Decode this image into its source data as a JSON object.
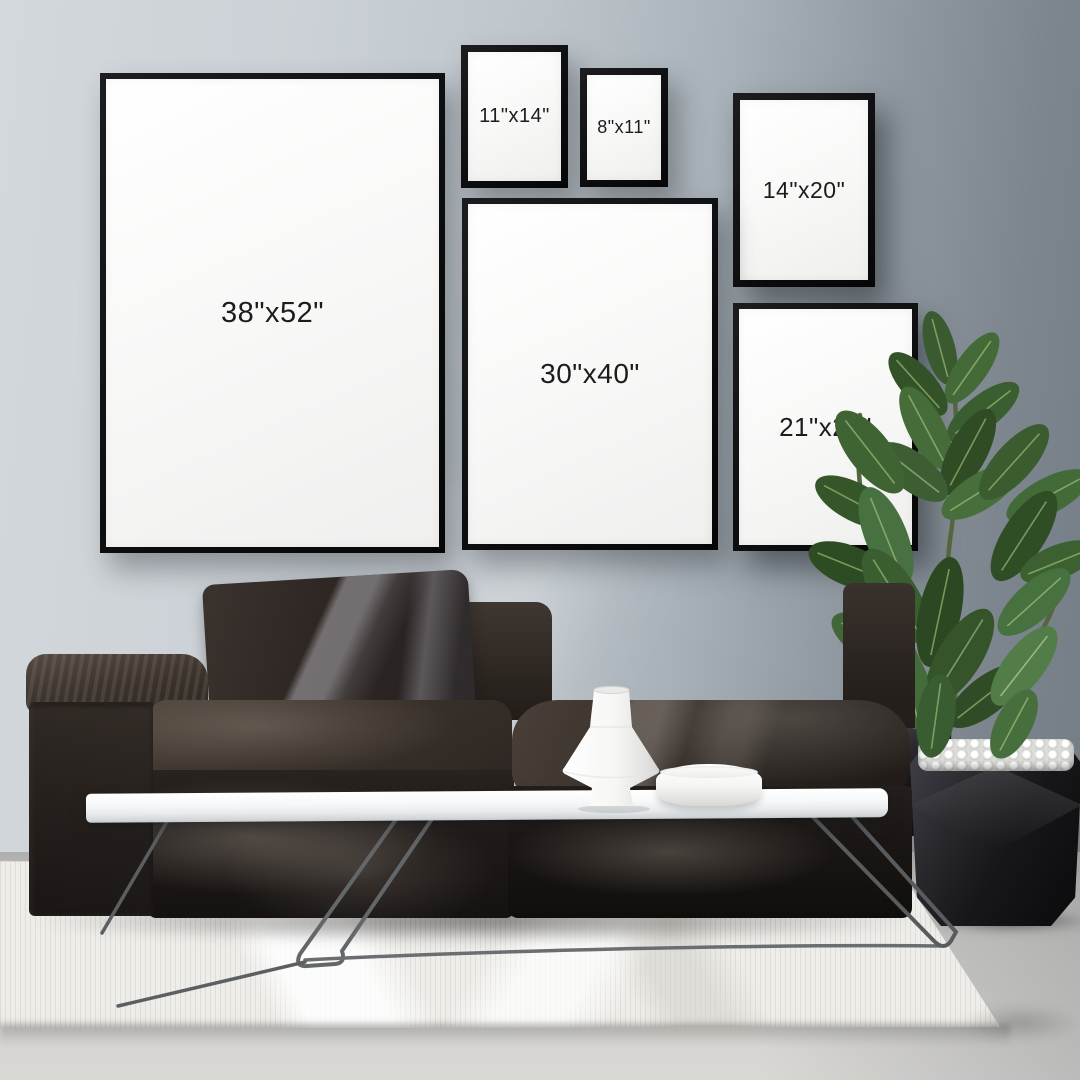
{
  "meta": {
    "description": "Living-room gallery-wall mockup comparing six black poster frame sizes",
    "canvas": "1080x1080"
  },
  "frames": [
    {
      "id": "38x52",
      "label": "38\"x52\""
    },
    {
      "id": "11x14",
      "label": "11\"x14\""
    },
    {
      "id": "8x11",
      "label": "8\"x11\""
    },
    {
      "id": "14x20",
      "label": "14\"x20\""
    },
    {
      "id": "30x40",
      "label": "30\"x40\""
    },
    {
      "id": "21x28",
      "label": "21\"x28\""
    }
  ],
  "palette": {
    "wall_left": "#d3d8dc",
    "wall_right": "#737c84",
    "frame_black": "#0e0e10",
    "poster_white": "#f7f7f6",
    "label_text": "#1c1c1d",
    "sofa_dark": "#241f1c",
    "sofa_light": "#4a403a",
    "table_top_white": "#f7f8f9",
    "leg_metal": "#6b6e71",
    "plant_green": "#3a5c2f",
    "plant_vein": "#b9d68a",
    "planter_black": "#17171a",
    "pebbles_white": "#dcdcd9",
    "rug_white": "#eeede9",
    "floor_concrete": "#cfcecb",
    "vase_white": "#ffffff"
  }
}
